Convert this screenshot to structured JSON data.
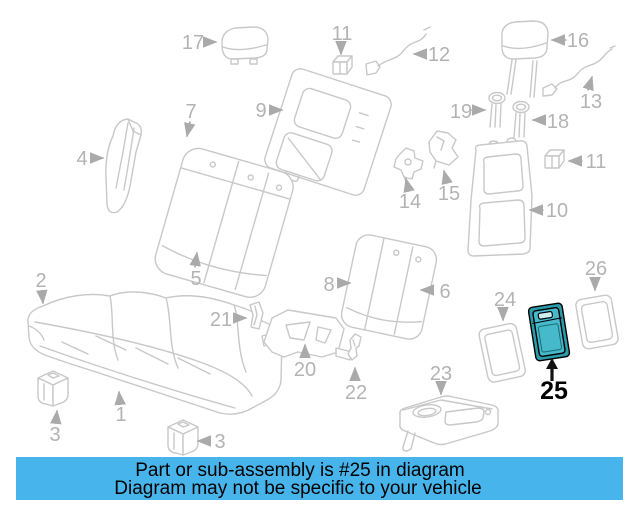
{
  "diagram": {
    "line_color": "#c8c8c8",
    "label_color": "#b3b3b3",
    "callouts": {
      "c1": "1",
      "c2": "2",
      "c3a": "3",
      "c3b": "3",
      "c4": "4",
      "c5": "5",
      "c6": "6",
      "c7": "7",
      "c8": "8",
      "c9": "9",
      "c10": "10",
      "c11a": "11",
      "c11b": "11",
      "c12": "12",
      "c13": "13",
      "c14": "14",
      "c15": "15",
      "c16": "16",
      "c17": "17",
      "c18": "18",
      "c19": "19",
      "c20": "20",
      "c21": "21",
      "c22": "22",
      "c23": "23",
      "c24": "24",
      "c26": "26"
    }
  },
  "highlight": {
    "part": "25",
    "fill": "#46b9cb",
    "back_fill": "#2d9aaa",
    "handle_fill": "#cfeef2",
    "outline": "#000000"
  },
  "banner": {
    "line1": "Part or sub-assembly is #25 in diagram",
    "line2": "Diagram may not be specific to your vehicle",
    "background": "#47b5ec",
    "text_color": "#000000"
  }
}
